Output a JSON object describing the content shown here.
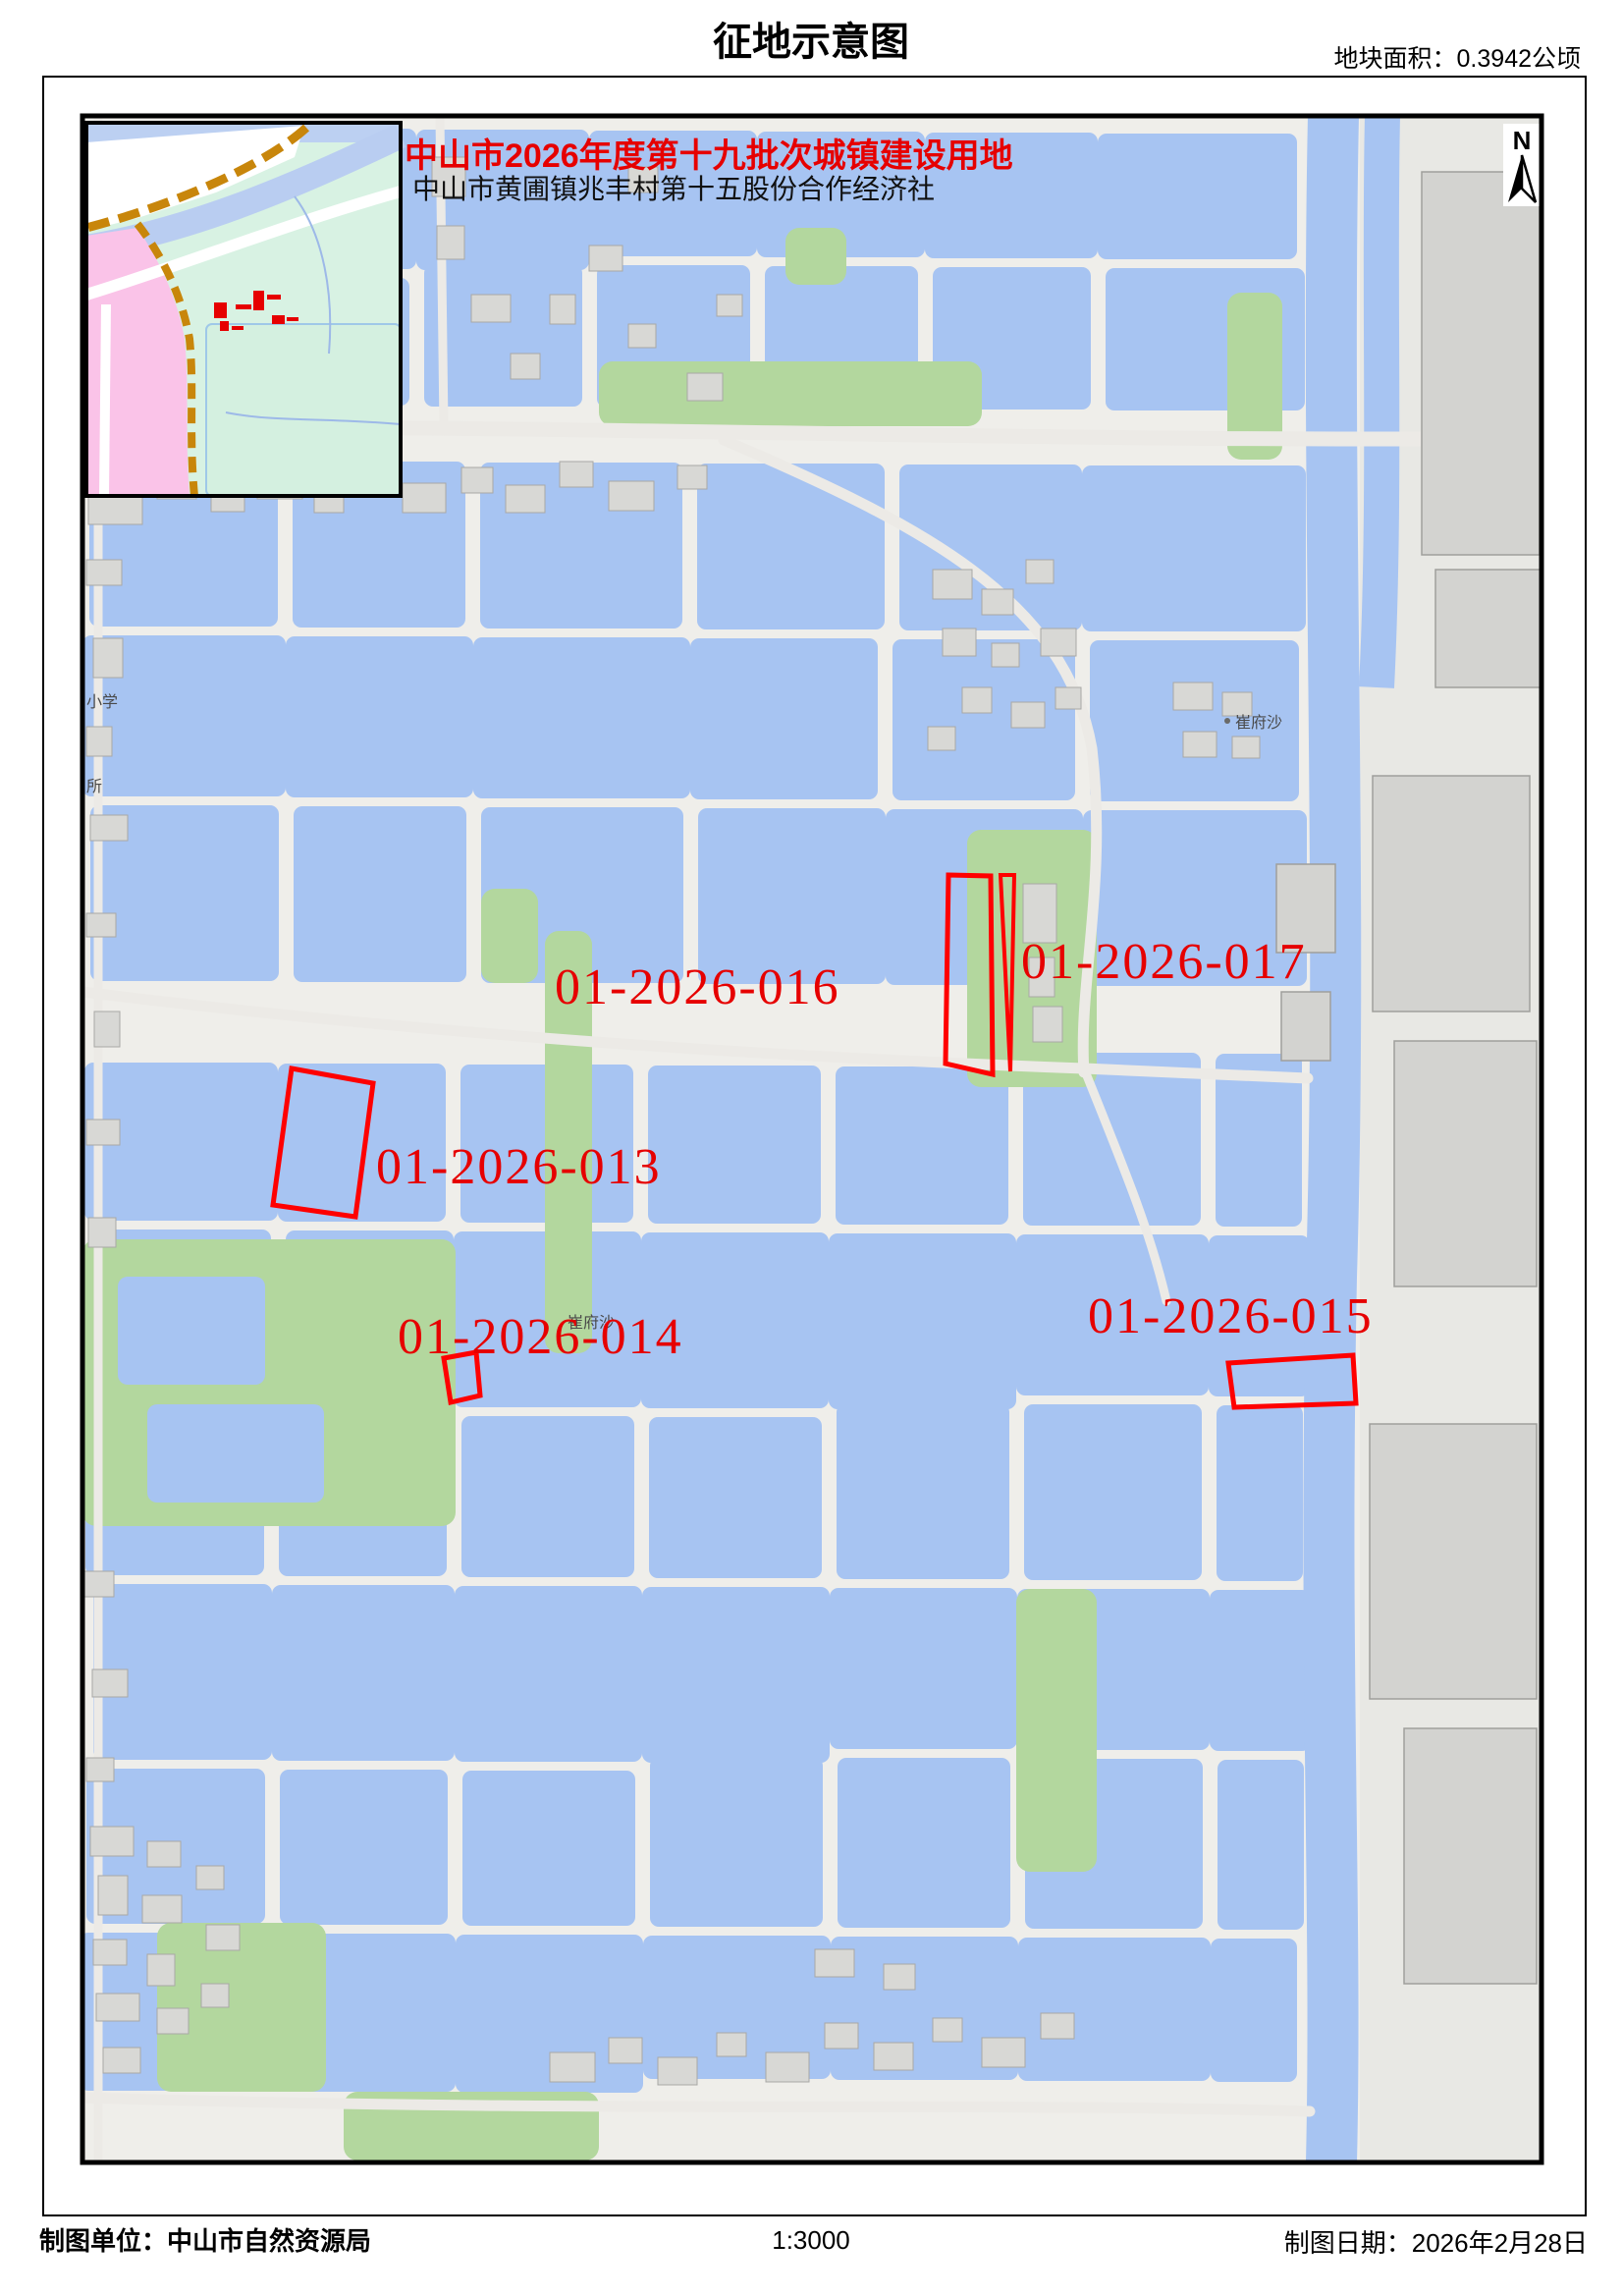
{
  "header": {
    "title": "征地示意图",
    "area_label": "地块面积：0.3942公顷"
  },
  "map": {
    "batch_title": "中山市2026年度第十九批次城镇建设用地",
    "coop_subtitle": "中山市黄圃镇兆丰村第十五股份合作经济社",
    "north_label": "N",
    "parcels": [
      {
        "id": "01-2026-013"
      },
      {
        "id": "01-2026-014"
      },
      {
        "id": "01-2026-015"
      },
      {
        "id": "01-2026-016"
      },
      {
        "id": "01-2026-017"
      }
    ],
    "place_labels": [
      {
        "name": "诊室"
      },
      {
        "name": "大滘百货"
      },
      {
        "name": "小学"
      },
      {
        "name": "所"
      },
      {
        "name": "崔府沙"
      },
      {
        "name": "崔府沙"
      }
    ]
  },
  "footer": {
    "agency": "制图单位：中山市自然资源局",
    "scale": "1:3000",
    "date": "制图日期：2026年2月28日"
  },
  "colors": {
    "parcel_red": "#ff0000",
    "label_red": "#e60000",
    "pond_blue": "#a7c4f2",
    "land_gray": "#efeeea",
    "building_gray": "#d8d8d5",
    "vegetation_green": "#b3d79e",
    "inset_pink": "#fac3e8",
    "inset_mint": "#d8f2e3",
    "boundary_orange": "#c8860b"
  }
}
